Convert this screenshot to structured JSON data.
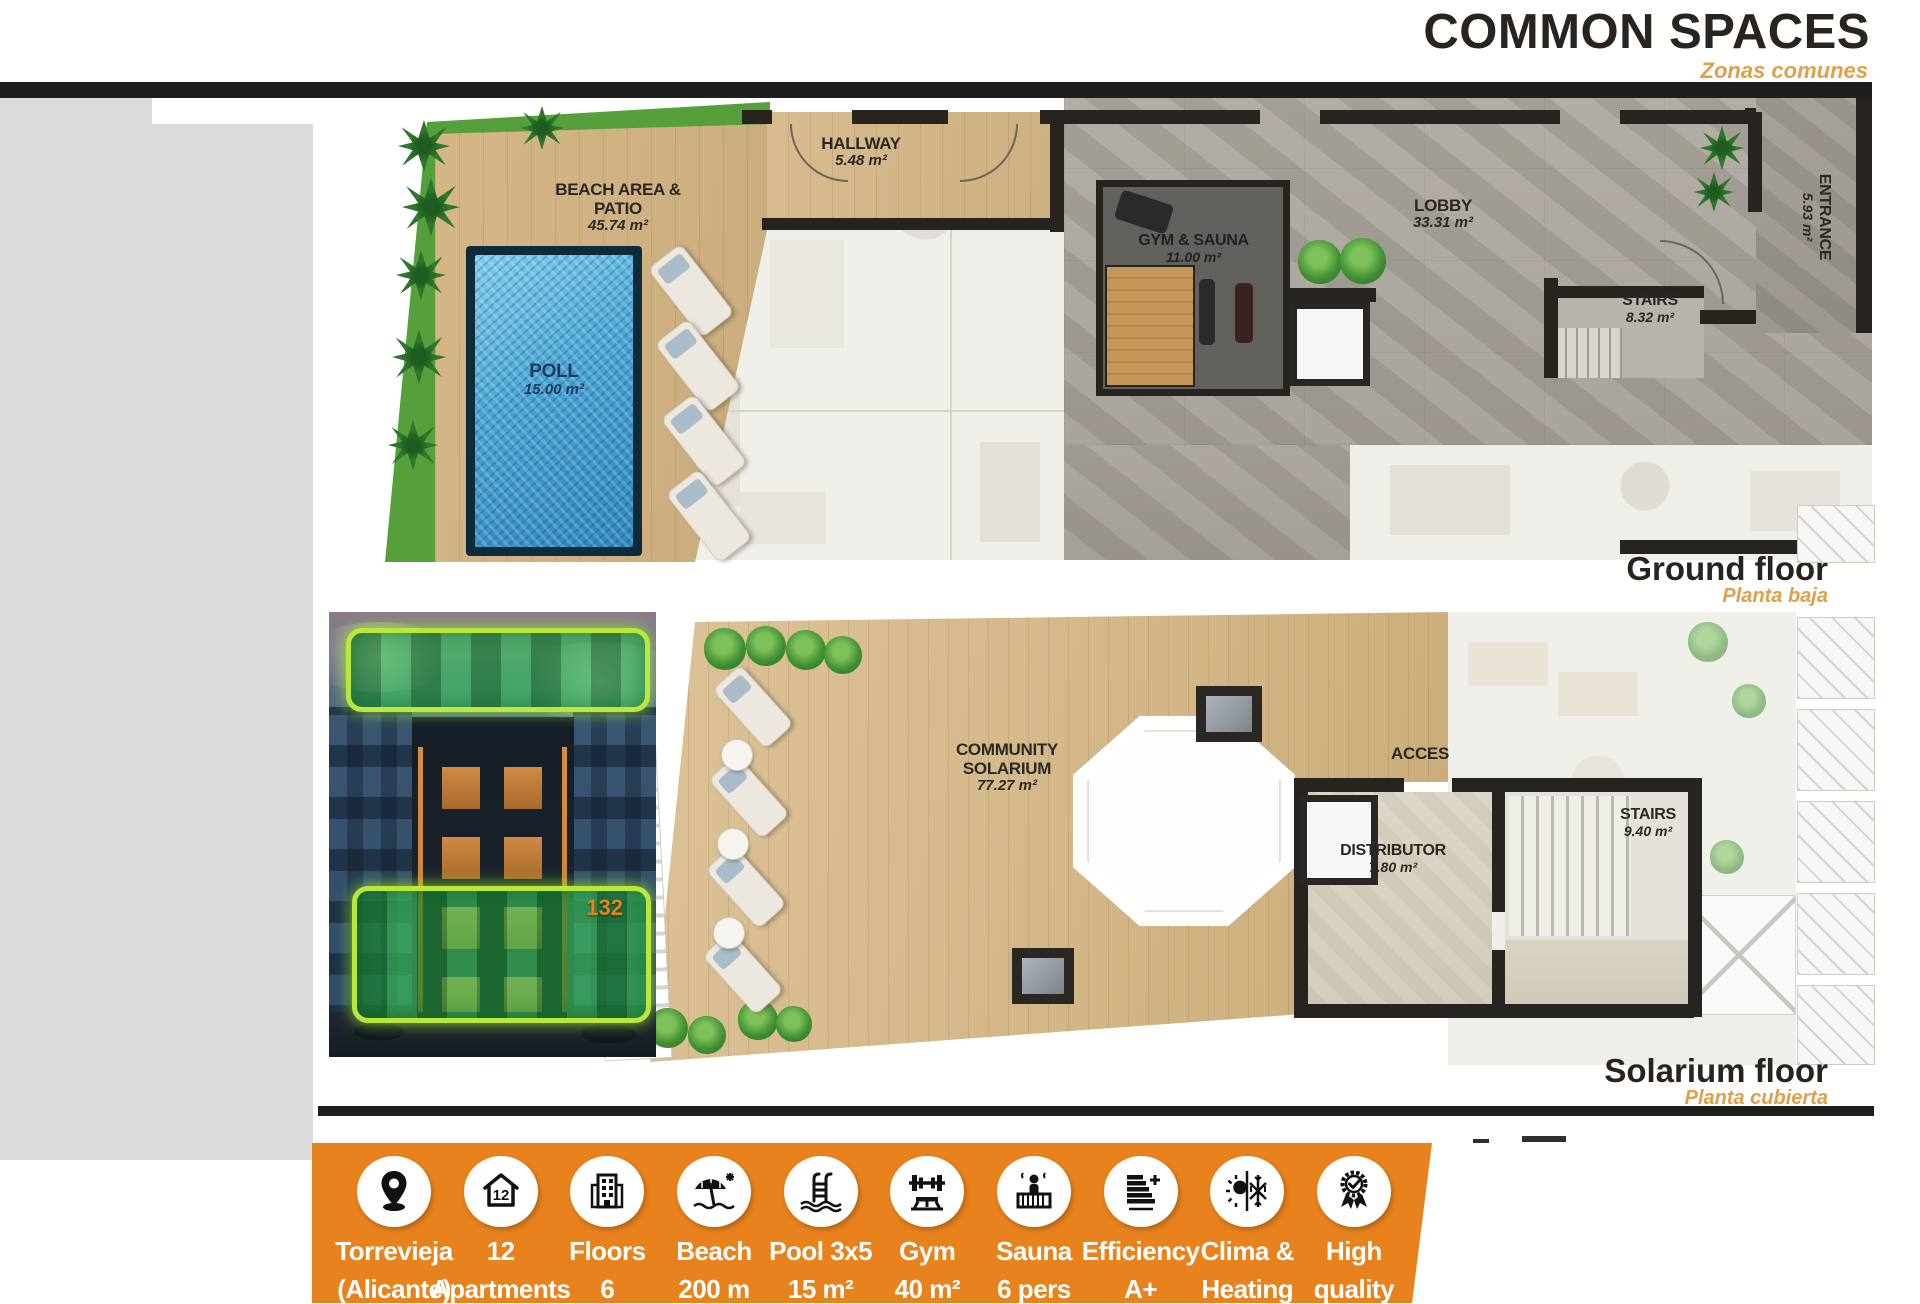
{
  "header": {
    "title": "COMMON SPACES",
    "subtitle": "Zonas comunes"
  },
  "colors": {
    "accent_orange": "#E8821D",
    "subtitle_orange": "#DFA04B",
    "bar_black": "#201D1B",
    "pool_blue": "#3D9CCD",
    "grass_green": "#55A03A",
    "highlight_green": "#2CBA46"
  },
  "ground_floor": {
    "caption": "Ground floor",
    "caption_es": "Planta baja",
    "rooms": {
      "beach": {
        "name": "BEACH AREA & PATIO",
        "area": "45.74 m²"
      },
      "pool": {
        "name": "POLL",
        "area": "15.00 m²"
      },
      "hallway": {
        "name": "HALLWAY",
        "area": "5.48 m²"
      },
      "gym": {
        "name": "GYM & SAUNA",
        "area": "11.00 m²"
      },
      "lobby": {
        "name": "LOBBY",
        "area": "33.31 m²"
      },
      "stairs": {
        "name": "STAIRS",
        "area": "8.32 m²"
      },
      "entrance": {
        "name": "ENTRANCE",
        "area": "5.93 m²"
      }
    }
  },
  "solarium_floor": {
    "caption": "Solarium floor",
    "caption_es": "Planta cubierta",
    "rooms": {
      "community": {
        "name_line1": "COMMUNITY",
        "name_line2": "SOLARIUM",
        "area": "77.27 m²"
      },
      "acces": {
        "name": "ACCES"
      },
      "distributor": {
        "name": "DISTRIBUTOR",
        "area": "7.80 m²"
      },
      "stairs": {
        "name": "STAIRS",
        "area": "9.40 m²"
      }
    }
  },
  "building_photo": {
    "unit_badge": "132"
  },
  "features": {
    "items": [
      {
        "icon": "location-pin-icon",
        "line1": "Torrevieja",
        "line2": "(Alicante)"
      },
      {
        "icon": "apartments-icon",
        "line1": "12",
        "line2": "Apartments"
      },
      {
        "icon": "floors-icon",
        "line1": "Floors",
        "line2": "6"
      },
      {
        "icon": "beach-icon",
        "line1": "Beach",
        "line2": "200 m"
      },
      {
        "icon": "pool-icon",
        "line1": "Pool 3x5",
        "line2": "15 m²"
      },
      {
        "icon": "gym-icon",
        "line1": "Gym",
        "line2": "40 m²"
      },
      {
        "icon": "sauna-icon",
        "line1": "Sauna",
        "line2": "6 pers"
      },
      {
        "icon": "efficiency-icon",
        "line1": "Efficiency",
        "line2": "A+"
      },
      {
        "icon": "clima-icon",
        "line1": "Clima &",
        "line2": "Heating"
      },
      {
        "icon": "quality-icon",
        "line1": "High",
        "line2": "quality"
      }
    ]
  }
}
